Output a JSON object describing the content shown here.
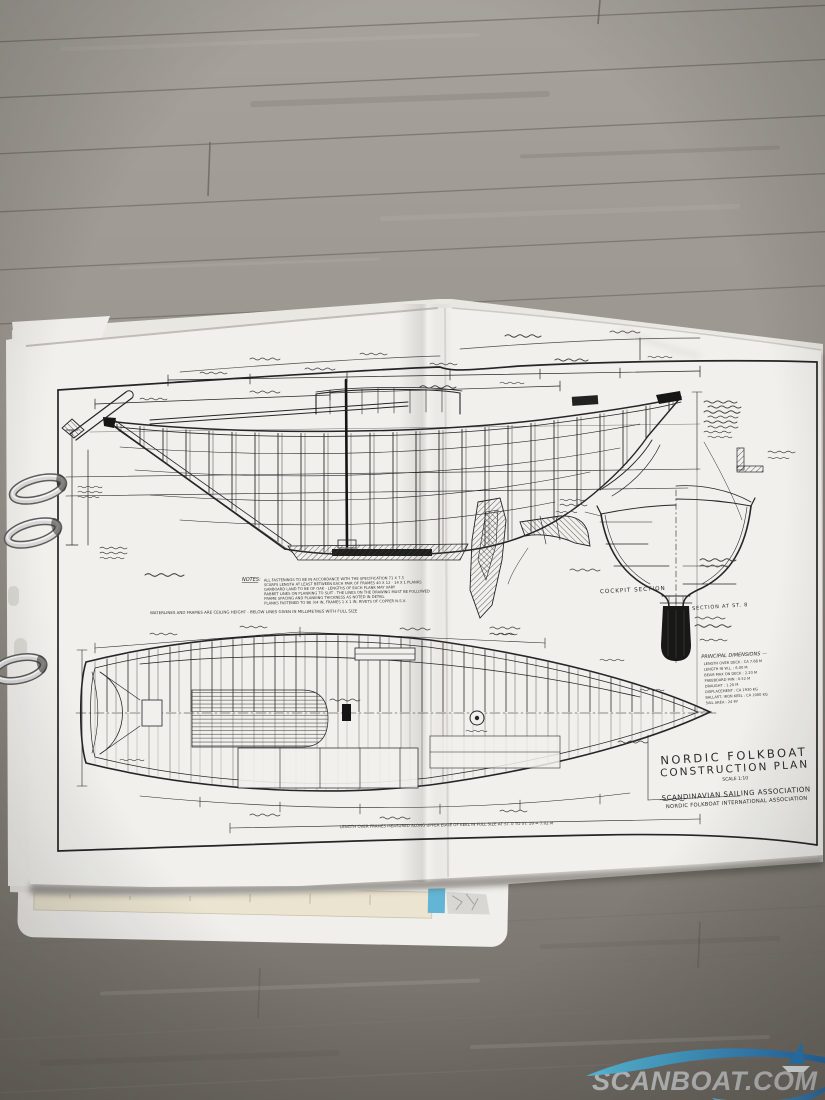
{
  "sheet": {
    "title_block": {
      "line1": "NORDIC FOLKBOAT",
      "line2": "CONSTRUCTION PLAN",
      "scale": "SCALE 1:10",
      "org1": "SCANDINAVIAN SAILING ASSOCIATION",
      "org2": "NORDIC FOLKBOAT INTERNATIONAL ASSOCIATION"
    },
    "labels": {
      "cockpit_section": "COCKPIT SECTION",
      "station_section": "SECTION AT ST. 8"
    },
    "notes": {
      "heading": "NOTES:",
      "lines": [
        "ALL FASTENINGS TO BE IN ACCORDANCE WITH THE SPECIFICATION 71 X 7.5",
        "SCARFS LENGTH AT LEAST BETWEEN EACH PAIR OF FRAMES 40 X 12 - 14 X 1 PLANKS",
        "GARBOARD LAND TO BE OF OAK - LENGTHS OF EACH PLANK MAY VARY",
        "RABBET LINES ON PLANKING TO SUIT - THE LINES ON THE DRAWING MUST BE FOLLOWED",
        "FRAME SPACING AND PLANKING THICKNESS AS NOTED IN DETAIL",
        "PLANKS FASTENED TO BE 3/4 IN, FRAMES 1 X 1 IN, RIVETS OF COPPER N.S.V."
      ],
      "footnote": "WATERLINES AND FRAMES ARE CEILING HEIGHT - BELOW LINES GIVEN IN MILLIMETRES WITH FULL SIZE"
    },
    "principal_dimensions": {
      "heading": "PRINCIPAL DIMENSIONS —",
      "lines": [
        "LENGTH OVER DECK : CA 7.68 M",
        "LENGTH IN W.L. : 6.00 M",
        "BEAM MAX ON DECK : 2.20 M",
        "FREEBOARD MIN : 0.52 M",
        "DRAUGHT : 1.20 M",
        "DISPLACEMENT : CA 1930 KG",
        "BALLAST, IRON KEEL : CA 1000 KG",
        "SAIL AREA : 24 M²"
      ]
    },
    "plan_footer": "LENGTH OVER FRAMES MEASURED ALONG UPPER EDGE OF KEEL IN FULL SIZE AT ST. 0 TO ST. 19 = 7.02 M"
  },
  "watermark": {
    "brand": "SCANBOAT.COM",
    "color_start": "#5cc9ea",
    "color_end": "#1a69b4"
  }
}
